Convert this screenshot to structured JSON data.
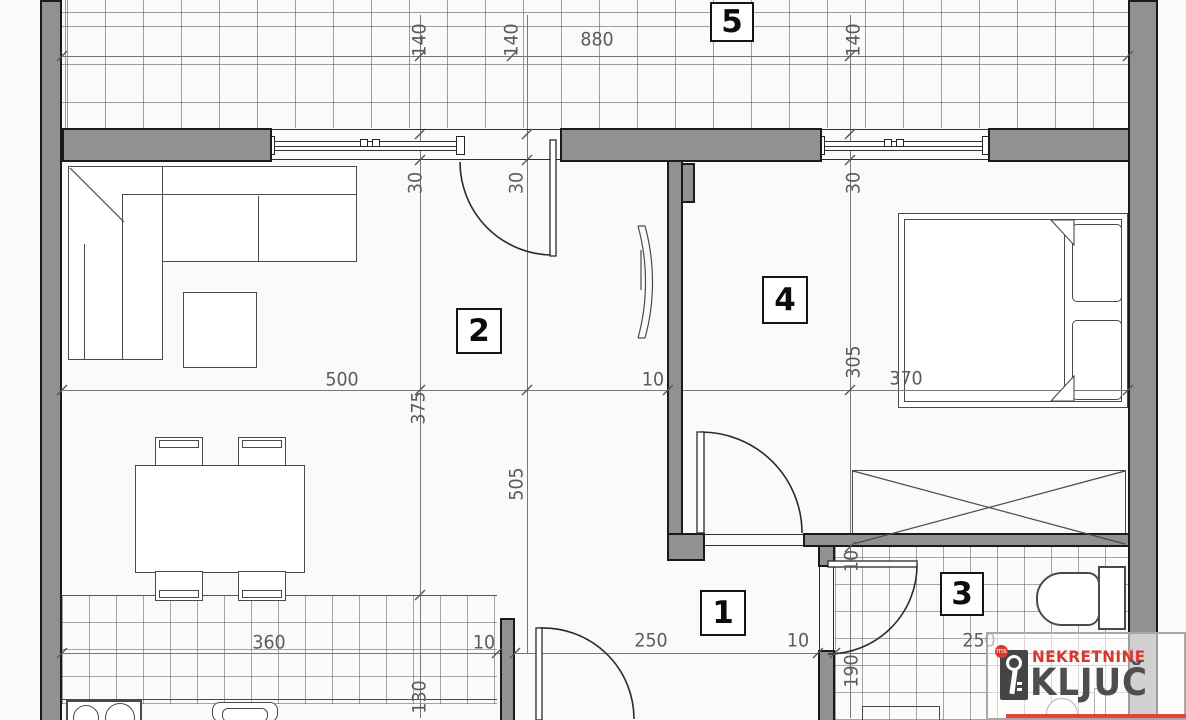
{
  "plan_title": "apartment-floor-plan",
  "rooms": {
    "r1": "1",
    "r2": "2",
    "r3": "3",
    "r4": "4",
    "r5": "5"
  },
  "dims": {
    "t140a": "140",
    "t140b": "140",
    "t880": "880",
    "t140c": "140",
    "w30a": "30",
    "w30b": "30",
    "w30c": "30",
    "m500": "500",
    "m375": "375",
    "m505": "505",
    "m10": "10",
    "m305": "305",
    "m370": "370",
    "b360": "360",
    "b10a": "10",
    "b250a": "250",
    "b10b": "10",
    "b250b": "250",
    "b130": "130",
    "b190": "190",
    "bath10": "10"
  },
  "logo": {
    "top": "NEKRETNINE",
    "bottom": "KLJUČ",
    "key_icon": "key-icon",
    "ms_badge": "ms"
  },
  "colors": {
    "wall_fill": "#919191",
    "wall_outline": "#1a1a1a",
    "dim_text": "#5c5c5c",
    "brand_red": "#d8372f",
    "brand_gray": "#4e4e4e",
    "paper": "#fbfaf8"
  }
}
